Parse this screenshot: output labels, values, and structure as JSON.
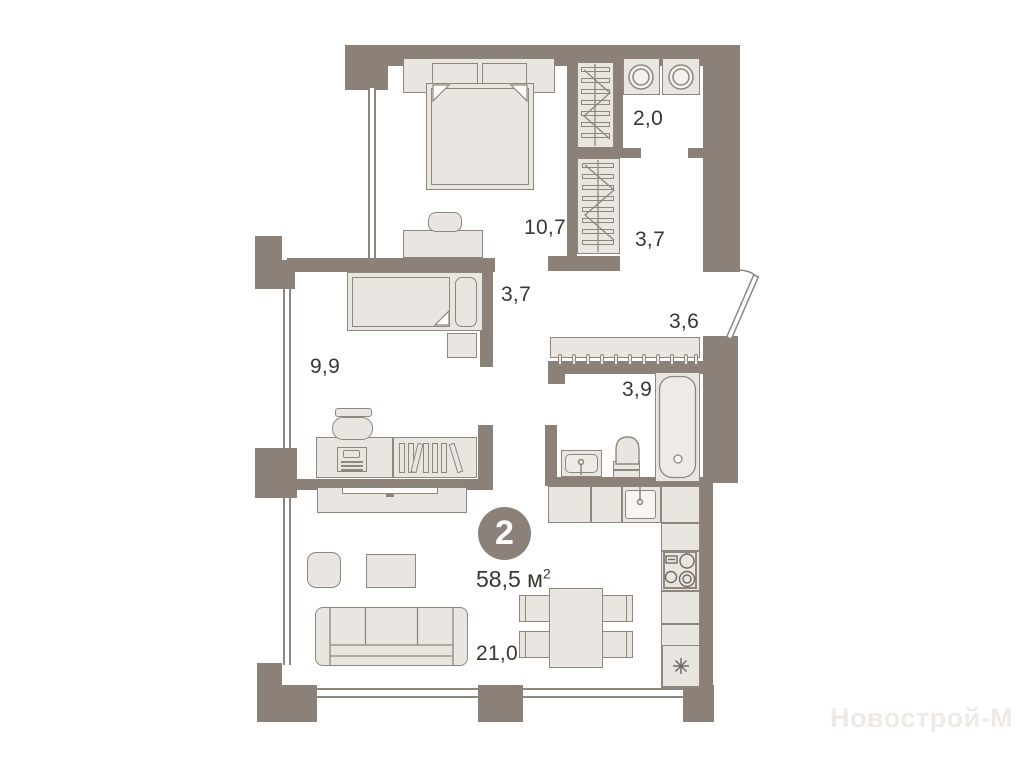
{
  "plan": {
    "badge": {
      "rooms_count": "2"
    },
    "area": {
      "value": "58,5",
      "unit": "м",
      "sup": "2"
    },
    "watermark": "Новострой-М",
    "rooms": {
      "bedroom_master": {
        "label": "10,7"
      },
      "laundry": {
        "label": "2,0"
      },
      "wardrobe": {
        "label": "3,7"
      },
      "corridor": {
        "label": "3,7"
      },
      "hallway": {
        "label": "3,6"
      },
      "bedroom_second": {
        "label": "9,9"
      },
      "bathroom": {
        "label": "3,9"
      },
      "living_kitchen": {
        "label": "21,0"
      }
    },
    "colors": {
      "wall": "#8b8178",
      "furniture_fill": "#e9e6e1",
      "outline": "#8f867e",
      "label_text": "#3a3733",
      "watermark": "#edeae7"
    }
  }
}
